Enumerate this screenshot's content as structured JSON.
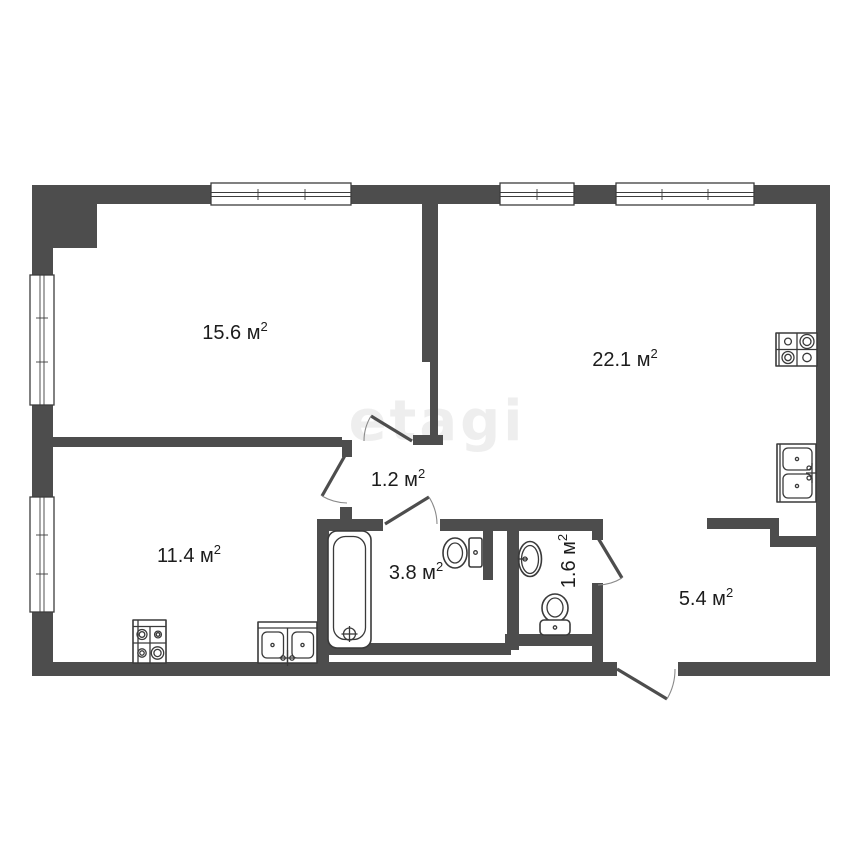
{
  "page": {
    "background": "#ffffff",
    "type": "apartment-floor-plan"
  },
  "watermark": {
    "text": "etagi"
  },
  "colors": {
    "wall": "#4d4d4d",
    "fixture_stroke": "#3a3a3a",
    "label": "#1c1c1c",
    "door_arc": "#8a8a8a",
    "watermark": "#c9c9c9"
  },
  "icons": [
    "stove-icon",
    "sink-icon",
    "toilet-icon",
    "bathtub-icon",
    "washbasin-icon",
    "window",
    "door-swing"
  ],
  "rooms": [
    {
      "key": "room-15-6",
      "area_value": "15.6",
      "area_unit": " м",
      "area_sup": "2"
    },
    {
      "key": "room-22-1",
      "area_value": "22.1",
      "area_unit": " м",
      "area_sup": "2"
    },
    {
      "key": "hall-1-2",
      "area_value": "1.2",
      "area_unit": " м",
      "area_sup": "2"
    },
    {
      "key": "bathroom-3-8",
      "area_value": "3.8",
      "area_unit": " м",
      "area_sup": "2"
    },
    {
      "key": "wc-1-6",
      "area_value": "1.6",
      "area_unit": " м",
      "area_sup": "2"
    },
    {
      "key": "hall-5-4",
      "area_value": "5.4",
      "area_unit": " м",
      "area_sup": "2"
    },
    {
      "key": "room-11-4",
      "area_value": "11.4",
      "area_unit": " м",
      "area_sup": "2"
    }
  ]
}
